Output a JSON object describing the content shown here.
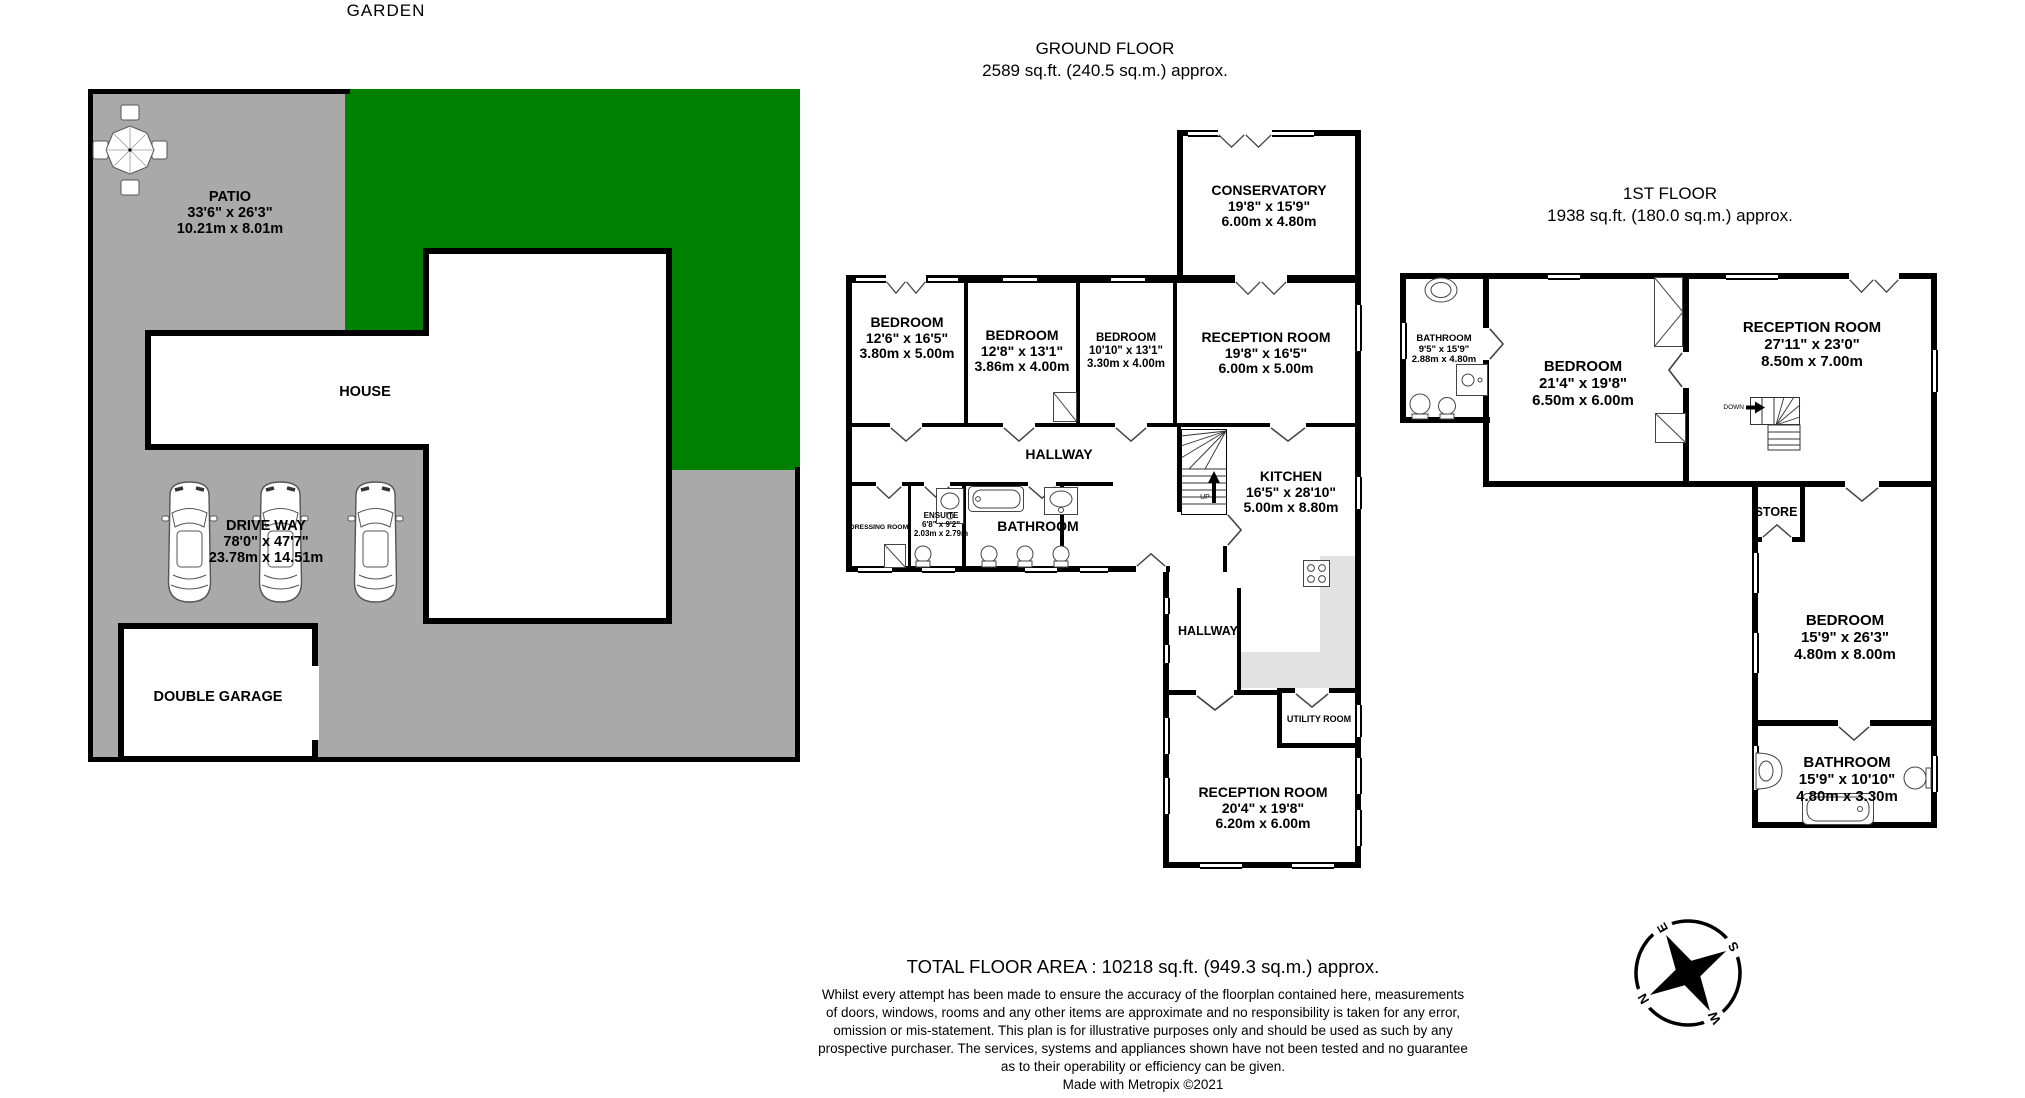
{
  "site_plan": {
    "garden_label": "GARDEN",
    "house_label": "HOUSE",
    "garage_label": "DOUBLE GARAGE",
    "patio": {
      "name": "PATIO",
      "imperial": "33'6\" x 26'3\"",
      "metric": "10.21m x 8.01m"
    },
    "driveway": {
      "name": "DRIVE WAY",
      "imperial": "78'0\" x 47'7\"",
      "metric": "23.78m x 14.51m"
    }
  },
  "ground_floor": {
    "title": "GROUND FLOOR",
    "subtitle": "2589 sq.ft. (240.5 sq.m.) approx.",
    "rooms": {
      "conservatory": {
        "name": "CONSERVATORY",
        "imperial": "19'8\" x 15'9\"",
        "metric": "6.00m x 4.80m"
      },
      "bedroom1": {
        "name": "BEDROOM",
        "imperial": "12'6\" x 16'5\"",
        "metric": "3.80m x 5.00m"
      },
      "bedroom2": {
        "name": "BEDROOM",
        "imperial": "12'8\" x 13'1\"",
        "metric": "3.86m x 4.00m"
      },
      "bedroom3": {
        "name": "BEDROOM",
        "imperial": "10'10\" x 13'1\"",
        "metric": "3.30m x 4.00m"
      },
      "reception1": {
        "name": "RECEPTION ROOM",
        "imperial": "19'8\" x 16'5\"",
        "metric": "6.00m x 5.00m"
      },
      "hallway": {
        "name": "HALLWAY"
      },
      "dressing": {
        "name": "DRESSING ROOM"
      },
      "ensuite": {
        "name": "ENSUITE",
        "imperial": "6'8\" x 9'2\"",
        "metric": "2.03m x 2.79m"
      },
      "bathroom": {
        "name": "BATHROOM"
      },
      "kitchen": {
        "name": "KITCHEN",
        "imperial": "16'5\" x 28'10\"",
        "metric": "5.00m x 8.80m"
      },
      "stairs_up": "UP",
      "hallway2": {
        "name": "HALLWAY"
      },
      "utility": {
        "name": "UTILITY ROOM"
      },
      "reception2": {
        "name": "RECEPTION ROOM",
        "imperial": "20'4\" x 19'8\"",
        "metric": "6.20m x 6.00m"
      }
    }
  },
  "first_floor": {
    "title": "1ST FLOOR",
    "subtitle": "1938 sq.ft. (180.0 sq.m.) approx.",
    "rooms": {
      "bathroom1": {
        "name": "BATHROOM",
        "imperial": "9'5\" x 15'9\"",
        "metric": "2.88m x 4.80m"
      },
      "bedroom1": {
        "name": "BEDROOM",
        "imperial": "21'4\" x 19'8\"",
        "metric": "6.50m x 6.00m"
      },
      "reception": {
        "name": "RECEPTION ROOM",
        "imperial": "27'11\" x 23'0\"",
        "metric": "8.50m x 7.00m"
      },
      "stairs_down": "DOWN",
      "store": {
        "name": "STORE"
      },
      "bedroom2": {
        "name": "BEDROOM",
        "imperial": "15'9\" x 26'3\"",
        "metric": "4.80m x 8.00m"
      },
      "bathroom2": {
        "name": "BATHROOM",
        "imperial": "15'9\" x 10'10\"",
        "metric": "4.80m x 3.30m"
      }
    }
  },
  "footer": {
    "total": "TOTAL FLOOR AREA : 10218 sq.ft. (949.3 sq.m.) approx.",
    "disclaimer_lines": [
      "Whilst every attempt has been made to ensure the accuracy of the floorplan contained here, measurements",
      "of doors, windows, rooms and any other items are approximate and no responsibility is taken for any error,",
      "omission or mis-statement. This plan is for illustrative purposes only and should be used as such by any",
      "prospective purchaser. The services, systems and appliances shown have not been tested and no guarantee",
      "as to their operability or efficiency can be given."
    ],
    "credit": "Made with Metropix ©2021"
  },
  "compass": {
    "n": "N",
    "e": "E",
    "s": "S",
    "w": "W"
  },
  "colors": {
    "garden_green": "#008000",
    "plot_grey": "#a9a9a9",
    "counter_grey": "#e2e2e2",
    "wall_black": "#000000"
  }
}
